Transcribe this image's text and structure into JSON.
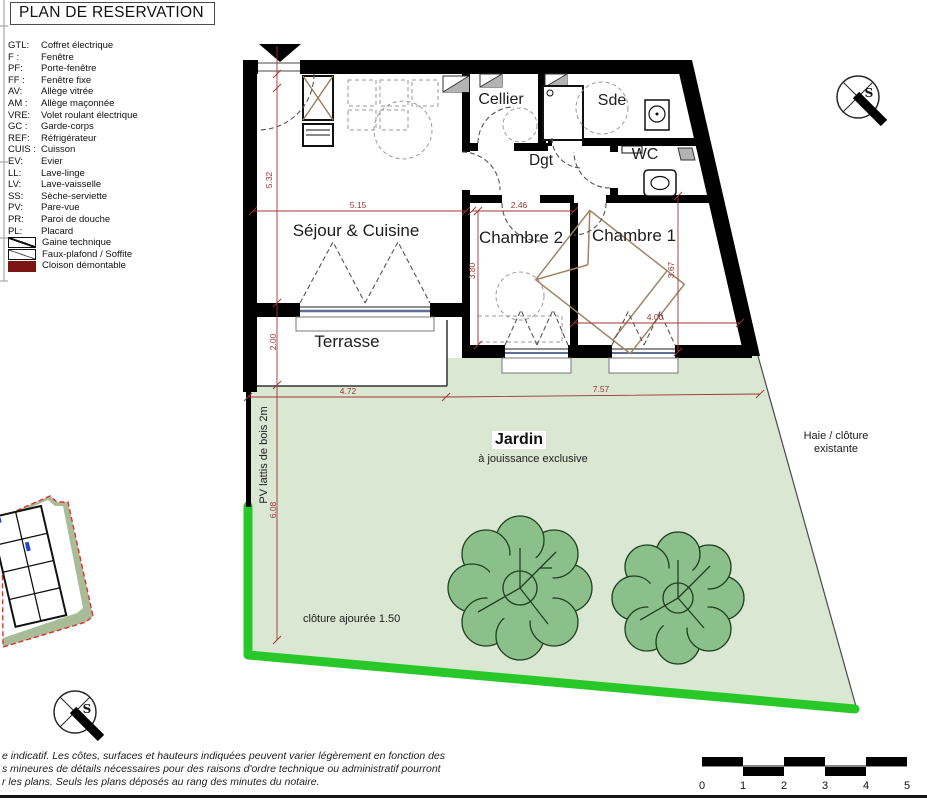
{
  "title": "PLAN DE RESERVATION",
  "legend": {
    "items": [
      {
        "abbr": "GTL:",
        "label": "Coffret électrique"
      },
      {
        "abbr": "F :",
        "label": "Fenêtre"
      },
      {
        "abbr": "PF:",
        "label": "Porte-fenêtre"
      },
      {
        "abbr": "FF :",
        "label": "Fenêtre fixe"
      },
      {
        "abbr": "AV:",
        "label": "Allège vitrée"
      },
      {
        "abbr": "AM :",
        "label": "Allège maçonnée"
      },
      {
        "abbr": "VRE:",
        "label": "Volet roulant électrique"
      },
      {
        "abbr": "GC :",
        "label": "Garde-corps"
      },
      {
        "abbr": "REF:",
        "label": "Réfrigérateur"
      },
      {
        "abbr": "CUIS :",
        "label": "Cuisson"
      },
      {
        "abbr": "EV:",
        "label": "Evier"
      },
      {
        "abbr": "LL:",
        "label": "Lave-linge"
      },
      {
        "abbr": "LV:",
        "label": "Lave-vaisselle"
      },
      {
        "abbr": "SS:",
        "label": "Sèche-serviette"
      },
      {
        "abbr": "PV:",
        "label": "Pare-vue"
      },
      {
        "abbr": "PR:",
        "label": "Paroi de douche"
      },
      {
        "abbr": "PL:",
        "label": "Placard"
      }
    ],
    "symbols": [
      {
        "name": "gaine-technique",
        "label": "Gaine technique"
      },
      {
        "name": "faux-plafond",
        "label": "Faux-plafond / Soffite"
      },
      {
        "name": "cloison-demontable",
        "label": "Cloison démontable",
        "color": "#7c1414"
      }
    ]
  },
  "plan": {
    "rooms": {
      "sejour": "Séjour & Cuisine",
      "cellier": "Cellier",
      "sde": "Sde",
      "dgt": "Dgt",
      "wc": "WC",
      "chambre2": "Chambre 2",
      "chambre1": "Chambre 1",
      "terrasse": "Terrasse"
    },
    "dimensions": {
      "sejour_h": "5.32",
      "sejour_w": "5.15",
      "chambre2_w": "2.46",
      "chambre2_h": "3.80",
      "chambre1_h": "3.67",
      "chambre1_w": "4.00",
      "terrasse_h": "2.00",
      "jardin_w_left": "4.72",
      "jardin_w_right": "7.57",
      "jardin_h": "6.08"
    },
    "annotations": {
      "jardin_title": "Jardin",
      "jardin_sub": "à jouissance exclusive",
      "haie_line1": "Haie / clôture",
      "haie_line2": "existante",
      "pv_lattis": "PV lattis de bois 2m",
      "cloture": "clôture ajourée 1.50"
    },
    "compass_letter": "S"
  },
  "footer": {
    "disclaimer_lines": [
      "e indicatif. Les côtes, surfaces et hauteurs indiquées peuvent varier légèrement en fonction des",
      "s mineures de détails nécessaires pour des raisons d'ordre technique ou administratif pourront",
      "r les plans. Seuls les plans déposés au rang des minutes du notaire."
    ],
    "scale_labels": [
      "0",
      "1",
      "2",
      "3",
      "4",
      "5"
    ]
  },
  "colors": {
    "garden": "#d9e7d3",
    "fence_green": "#29c829",
    "tree_fill": "#8cc08a",
    "tree_stroke": "#1f4020",
    "dimension_red": "#a03434",
    "cloison_red": "#7c1414",
    "site_band_green": "#a7bc97",
    "site_border_red": "#e03030"
  }
}
